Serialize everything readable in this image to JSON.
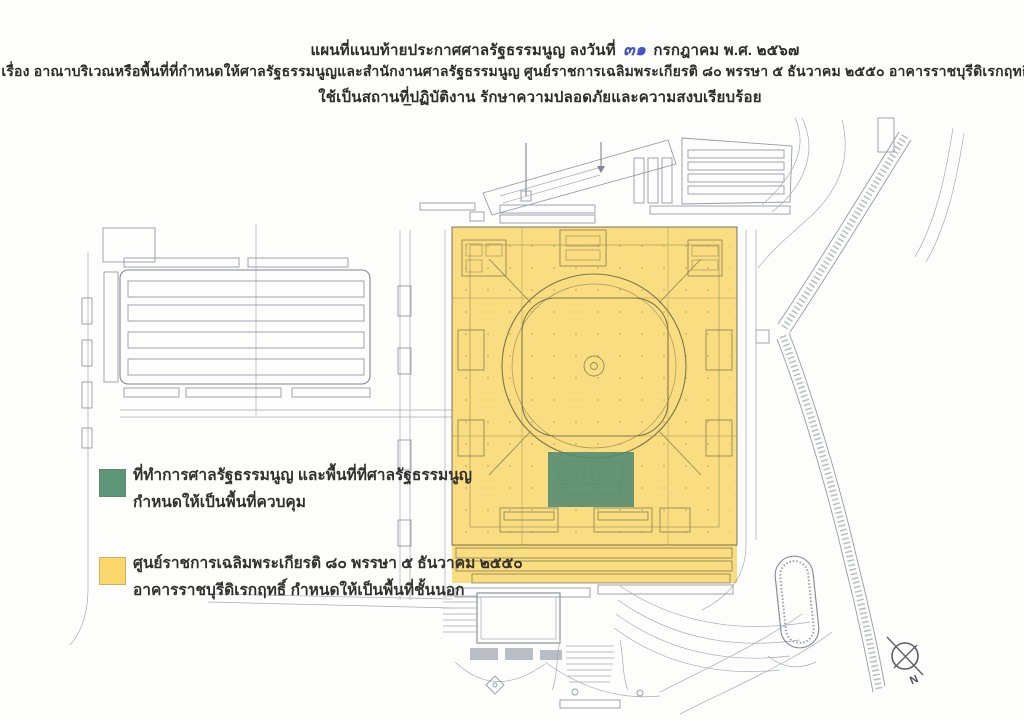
{
  "header": {
    "line1_prefix": "แผนที่แนบท้ายประกาศศาลรัฐธรรมนูญ  ลงวันที่",
    "line1_handwritten_date": "๓๑",
    "line1_suffix": "กรกฎาคม  พ.ศ. ๒๕๖๗",
    "line2": "เรื่อง  อาณาบริเวณหรือพื้นที่ที่กำหนดให้ศาลรัฐธรรมนูญและสำนักงานศาลรัฐธรรมนูญ  ศูนย์ราชการเฉลิมพระเกียรติ ๘๐ พรรษา ๕ ธันวาคม ๒๕๕๐ อาคารราชบุรีดิเรกฤทธิ์",
    "line3": "ใช้เป็นสถานที่ปฏิบัติงาน  รักษาความปลอดภัยและความสงบเรียบร้อย",
    "dash": "–"
  },
  "legend": {
    "items": [
      {
        "color": "#5d9579",
        "label_line1": "ที่ทำการศาลรัฐธรรมนูญ และพื้นที่ที่ศาลรัฐธรรมนูญ",
        "label_line2": "กำหนดให้เป็นพื้นที่ควบคุม"
      },
      {
        "color": "#fbd76e",
        "label_line1": "ศูนย์ราชการเฉลิมพระเกียรติ ๘๐ พรรษา ๕ ธันวาคม ๒๕๕๐",
        "label_line2": "อาคารราชบุรีดิเรกฤทธิ์ กำหนดให้เป็นพื้นที่ชั้นนอก"
      }
    ]
  },
  "map": {
    "compass_label": "N",
    "overlay_colors": {
      "outer_zone_yellow": "#fbd65f",
      "controlled_zone_green": "#4e8a72"
    }
  }
}
